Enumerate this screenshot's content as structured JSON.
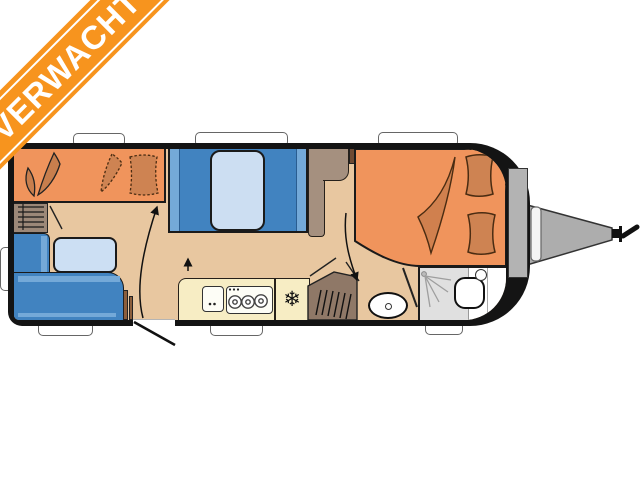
{
  "banner": {
    "label": "VERWACHT",
    "color": "#F7941E",
    "text_color": "#FFFFFF"
  },
  "icons": {
    "snowflake_glyph": "❄"
  },
  "palette": {
    "banner_orange": "#F7941E",
    "body_black": "#141414",
    "floor_beige": "#E8C7A0",
    "bed_orange": "#F0945C",
    "cushion_orange": "#CE8352",
    "blanket_orange": "#D0804E",
    "sofa_blue": "#4183C0",
    "sofa_blue_light": "#74A9D8",
    "mattress_blue": "#CCDEF2",
    "table_blue": "#CCDFF3",
    "wardrobe_taupe": "#A5907F",
    "door_wood_brown": "#8B5E3C",
    "kitchen_yellow": "#F7EDC4",
    "heater_brown": "#8F7867",
    "shower_grey": "#E0E0E0",
    "drawbar_grey": "#ADADAD",
    "window_white": "#FFFFFF"
  },
  "floorplan": {
    "type": "caravan-top-view",
    "fixtures": [
      "front-bed",
      "bunk-beds",
      "rear-french-bed",
      "l-shaped-sofa",
      "dinette-table",
      "kitchen-sink",
      "three-burner-stove",
      "fridge",
      "heater",
      "wardrobe",
      "shower",
      "toilet",
      "washbasin",
      "entrance-door",
      "drawbar-hitch"
    ],
    "window_count": 7
  }
}
